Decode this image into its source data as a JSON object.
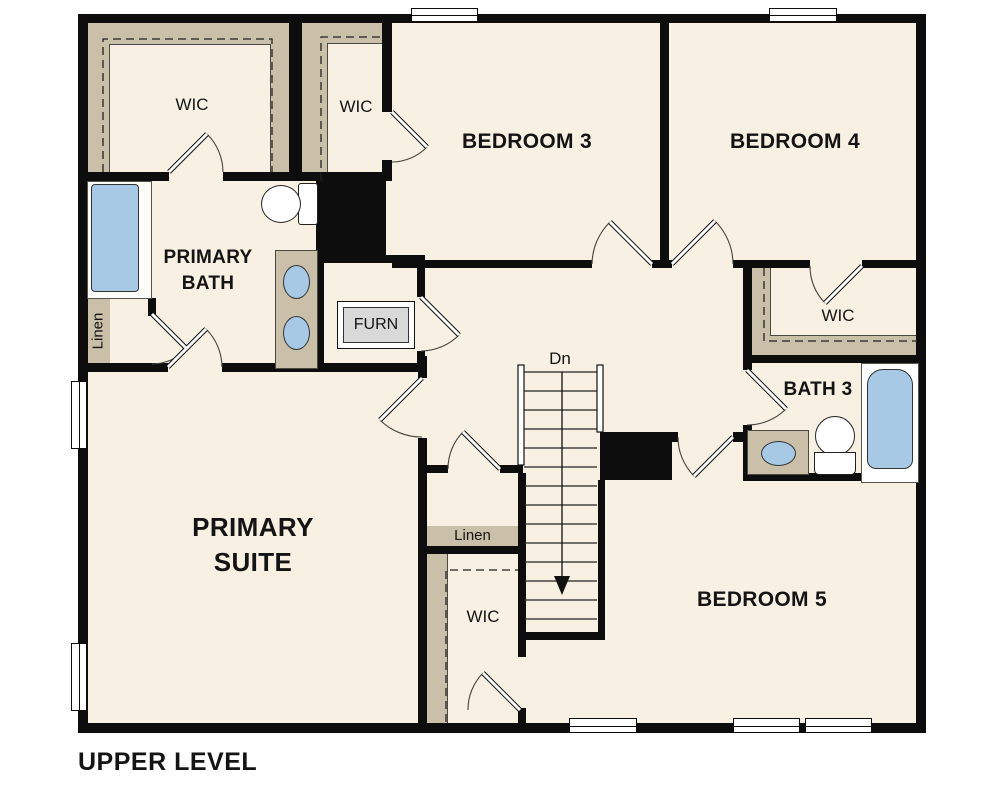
{
  "plan_title": "UPPER LEVEL",
  "colors": {
    "floor": "#f7f0e3",
    "wall": "#0d0d0d",
    "shelving_tan": "#cabfa8",
    "fixture_blue": "#a7c9e6",
    "furnace_gray": "#d9d9d9",
    "background": "#ffffff"
  },
  "labels": {
    "wic_top_left": "WIC",
    "wic_bedroom3": "WIC",
    "bedroom3": "BEDROOM 3",
    "bedroom4": "BEDROOM 4",
    "primary_bath_line1": "PRIMARY",
    "primary_bath_line2": "BATH",
    "linen_bath": "Linen",
    "furnace": "FURN",
    "wic_bedroom4": "WIC",
    "bath3": "BATH 3",
    "stairs_down": "Dn",
    "linen_hall": "Linen",
    "wic_hall": "WIC",
    "primary_suite_line1": "PRIMARY",
    "primary_suite_line2": "SUITE",
    "bedroom5": "BEDROOM 5"
  },
  "fixtures": [
    "shower",
    "toilet-primary-bath",
    "double-vanity-primary-bath",
    "furnace-unit",
    "vanity-bath3",
    "toilet-bath3",
    "tub-bath3",
    "stairs-down",
    "windows-x7"
  ]
}
